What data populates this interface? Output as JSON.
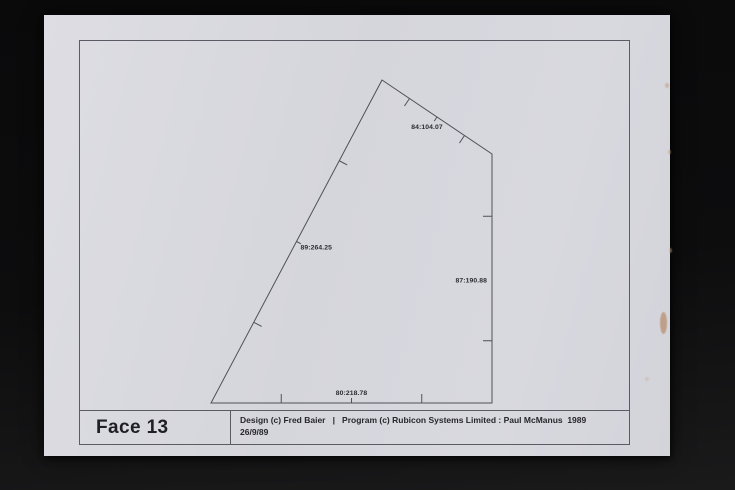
{
  "photo": {
    "background_color": "#0a0a0b",
    "paper_color": "#d8d8df",
    "stains": [
      {
        "x": 621,
        "y": 68,
        "w": 4,
        "h": 5,
        "color": "#c09c7c",
        "opacity": 0.55
      },
      {
        "x": 624,
        "y": 135,
        "w": 3,
        "h": 4,
        "color": "#bd9878",
        "opacity": 0.5
      },
      {
        "x": 625,
        "y": 233,
        "w": 3,
        "h": 5,
        "color": "#c3a183",
        "opacity": 0.5
      },
      {
        "x": 616,
        "y": 297,
        "w": 7,
        "h": 22,
        "color": "#b58a64",
        "opacity": 0.7
      },
      {
        "x": 601,
        "y": 362,
        "w": 4,
        "h": 4,
        "color": "#c6a88c",
        "opacity": 0.35
      }
    ]
  },
  "title_block": {
    "face_label": "Face 13",
    "credit_line1": "Design (c) Fred Baier   |   Program (c) Rubicon Systems Limited : Paul McManus  1989",
    "credit_line2": "26/9/89"
  },
  "drawing": {
    "type": "outline-plot",
    "line_color": "#50505a",
    "label_color": "#2b2b31",
    "vertices": [
      [
        338,
        65
      ],
      [
        448,
        139
      ],
      [
        448,
        388
      ],
      [
        167,
        388
      ]
    ],
    "edges": [
      {
        "from": 0,
        "to": 1,
        "label": "84:104.07",
        "anchor": "middle",
        "dx": -10,
        "dy": 12,
        "ticks": [
          0.25,
          0.5,
          0.75
        ]
      },
      {
        "from": 1,
        "to": 2,
        "label": "87:190.88",
        "anchor": "end",
        "dx": -5,
        "dy": 4,
        "ticks": [
          0.25,
          0.75
        ]
      },
      {
        "from": 2,
        "to": 3,
        "label": "80:218.78",
        "anchor": "middle",
        "dx": 0,
        "dy": -8,
        "ticks": [
          0.25,
          0.5,
          0.75
        ]
      },
      {
        "from": 3,
        "to": 0,
        "label": "89:264.25",
        "anchor": "start",
        "dx": 4,
        "dy": 8,
        "ticks": [
          0.25,
          0.5,
          0.75
        ]
      }
    ]
  }
}
